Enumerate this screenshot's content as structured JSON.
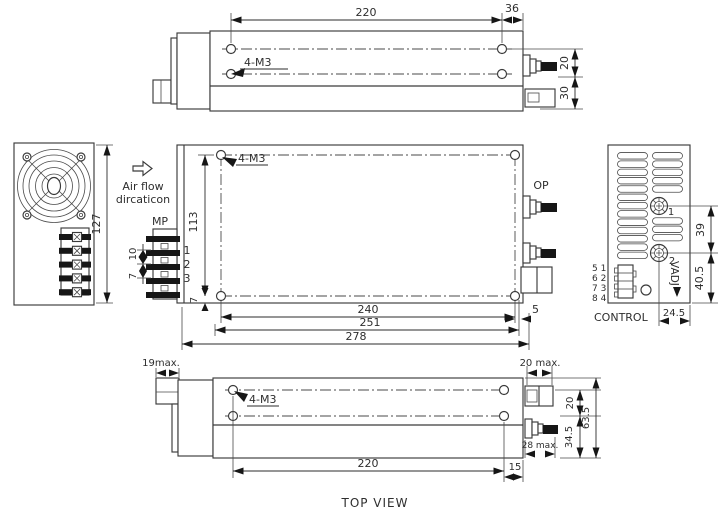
{
  "drawing": {
    "caption": "TOP VIEW",
    "top_view": {
      "label_4m3": "4-M3",
      "dim_220": "220",
      "dim_36": "36",
      "dim_20": "20",
      "dim_30": "30"
    },
    "front_view": {
      "dim_127": "127"
    },
    "airflow": {
      "line1": "Air flow",
      "line2": "dircaticon"
    },
    "plan_view": {
      "label_4m3": "4-M3",
      "label_mp": "MP",
      "label_op": "OP",
      "pins": [
        "1",
        "2",
        "3"
      ],
      "dim_113": "113",
      "dim_10": "10",
      "dim_7_pitch": "7",
      "dim_7_edge": "7",
      "dim_240": "240",
      "dim_251": "251",
      "dim_278": "278",
      "dim_5": "5"
    },
    "rear_view": {
      "label_control": "CONTROL",
      "label_vadj": "VADJ",
      "pot_labels": [
        "1",
        "2"
      ],
      "pin_rows": [
        "5 1",
        "6 2",
        "7 3",
        "8 4"
      ],
      "dim_39": "39",
      "dim_40_5": "40.5",
      "dim_24_5": "24.5"
    },
    "bottom_view": {
      "label_4m3": "4-M3",
      "dim_19max": "19max.",
      "dim_20max": "20 max.",
      "dim_28max": "28 max.",
      "dim_220": "220",
      "dim_15": "15",
      "dim_20": "20",
      "dim_34_5": "34.5",
      "dim_63_5": "63.5"
    }
  },
  "colors": {
    "line": "#3a3a3a",
    "fill_black": "#161616",
    "background": "#ffffff"
  }
}
